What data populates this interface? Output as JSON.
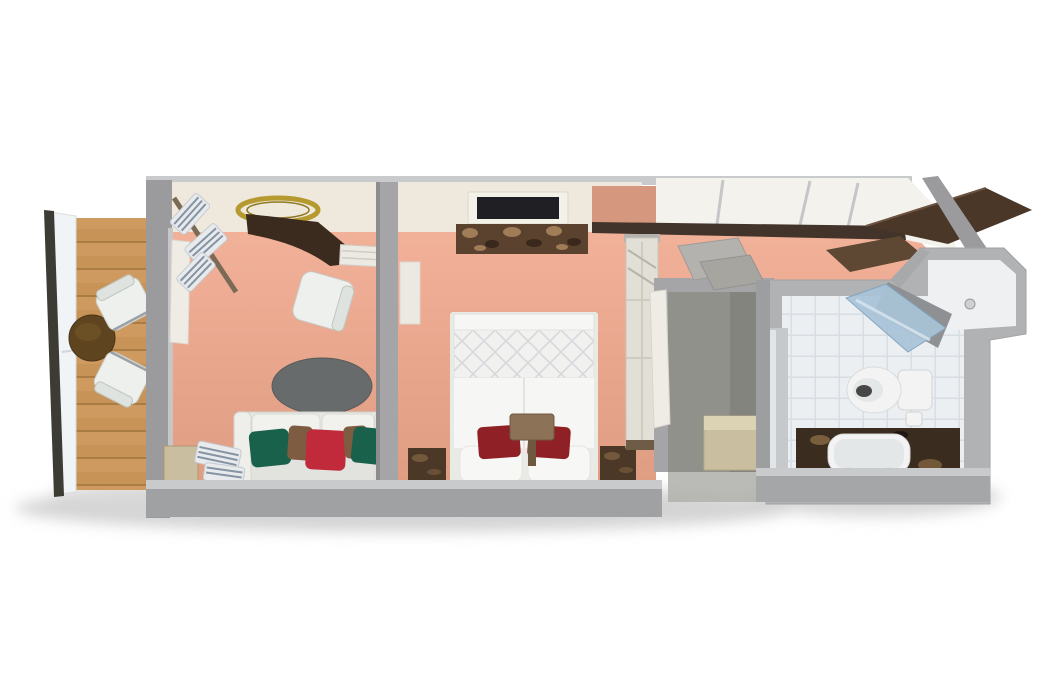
{
  "figure": {
    "title": "3D cutaway floor plan of a suite cabin with balcony, living room, bedroom, walk-in closet and bathroom",
    "view": "top-down isometric 3D render",
    "background": "#ffffff"
  },
  "palette": {
    "shadow": "#cccccc",
    "wood": "#c79357",
    "woodBand": "#d2a066",
    "woodLine": "#a87c42",
    "railWhite": "#f1f4f6",
    "railRod": "#3c3c34",
    "tableBrown": "#5f451f",
    "chairWhite": "#eef0ee",
    "chairBack": "#dfe3df",
    "wallGray": "#9b9b9d",
    "wallGrayMid": "#a5a5a7",
    "wallGrayLight": "#c9cacc",
    "wallCream": "#efe9dd",
    "wallWhite": "#f3f2ed",
    "wallSalmon": "#d6977f",
    "darkRail": "#42342a",
    "roofBrown": "#4b3727",
    "shelfBrown": "#5e4834",
    "floorTop": "#f2b199",
    "floorBottom": "#df9d82",
    "linenWhite": "#e8eaec",
    "linenStripe": "#8594a4",
    "goldRim": "#b69a30",
    "vanityBrown": "#3b2b1e",
    "consoleWhite": "#ebe9e2",
    "rugGray": "#686b6b",
    "sofaBody": "#e7e7e4",
    "sofaCushion": "#f1f1ee",
    "sofaBack": "#e2e2de",
    "pillowGreen": "#19614b",
    "pillowRed": "#c02a3a",
    "pillowBrown": "#7d5c41",
    "tvFrame": "#f4f1e9",
    "tvScreen": "#202024",
    "dresserBrown": "#5a422e",
    "dresserFleckLight": "#a8835c",
    "dresserFleckDark": "#36261a",
    "bedWhite": "#f6f6f4",
    "quiltBase": "#f1f1ef",
    "bedPillowWhite": "#f7f7f5",
    "accentPillowRed": "#8e2026",
    "headboardBrown": "#8c7357",
    "headboardDark": "#6e5940",
    "nightstandBrown": "#4c3826",
    "nightstandStreak": "#7d6042",
    "wardrobeWhite": "#e2dfd7",
    "wardrobeTrim": "#6f5c47",
    "closetFloor": "#90918a",
    "closetFloorDark": "#83847d",
    "doorWhite": "#eeece5",
    "cabinetGray": "#a0a1a3",
    "cabinetPanel": "#ecebe7",
    "entryDoorTan": "#c9be9f",
    "entryDoorTop": "#dcd2b4",
    "tileBase": "#ebeff2",
    "tileLine": "#d7dee3",
    "showerGlass": "#a8c3d7",
    "showerWall": "#8f9094",
    "porcelain": "#f2f3f2",
    "porcelainShade": "#e4e7e7",
    "toiletHole": "#474747",
    "marbleDark": "#3a2c1e",
    "marbleStreak": "#8a6a45",
    "mirrorGray": "#c6c9cc",
    "mirrorHighlight": "#e2e5e8"
  },
  "rooms": [
    {
      "id": "balcony",
      "label": "Balcony",
      "floor": "wood plank deck",
      "furniture": [
        "round cocktail table",
        "deck chair",
        "deck chair",
        "railing with white panel"
      ]
    },
    {
      "id": "living-room",
      "label": "Living room",
      "floor": "salmon carpet",
      "furniture": [
        "three-seat sofa with green, brown and red pillows",
        "dark oval rug",
        "desk chair",
        "curved dark vanity desk",
        "gold round wall mirror",
        "wall shelves with striped linens",
        "white console shelf",
        "open balcony door"
      ]
    },
    {
      "id": "bedroom",
      "label": "Bedroom",
      "floor": "salmon carpet",
      "furniture": [
        "double bed with diamond-quilted duvet",
        "two white pillows",
        "two dark-red accent pillows",
        "brown headboard panel",
        "left marble nightstand",
        "right marble nightstand",
        "wall-mounted TV",
        "stone-front dresser",
        "tall wardrobe"
      ]
    },
    {
      "id": "closet",
      "label": "Walk-in closet",
      "floor": "grey",
      "furniture": [
        "corner shelf",
        "corner shelf",
        "upper cabinet with divider",
        "open white door"
      ]
    },
    {
      "id": "entrance",
      "label": "Entrance hall",
      "floor": "grey",
      "furniture": [
        "entry door"
      ]
    },
    {
      "id": "bathroom",
      "label": "Bathroom",
      "floor": "white tile",
      "furniture": [
        "toilet",
        "bathtub set in dark marble deck",
        "corner shower with blue glass door",
        "mirror panel"
      ]
    }
  ]
}
